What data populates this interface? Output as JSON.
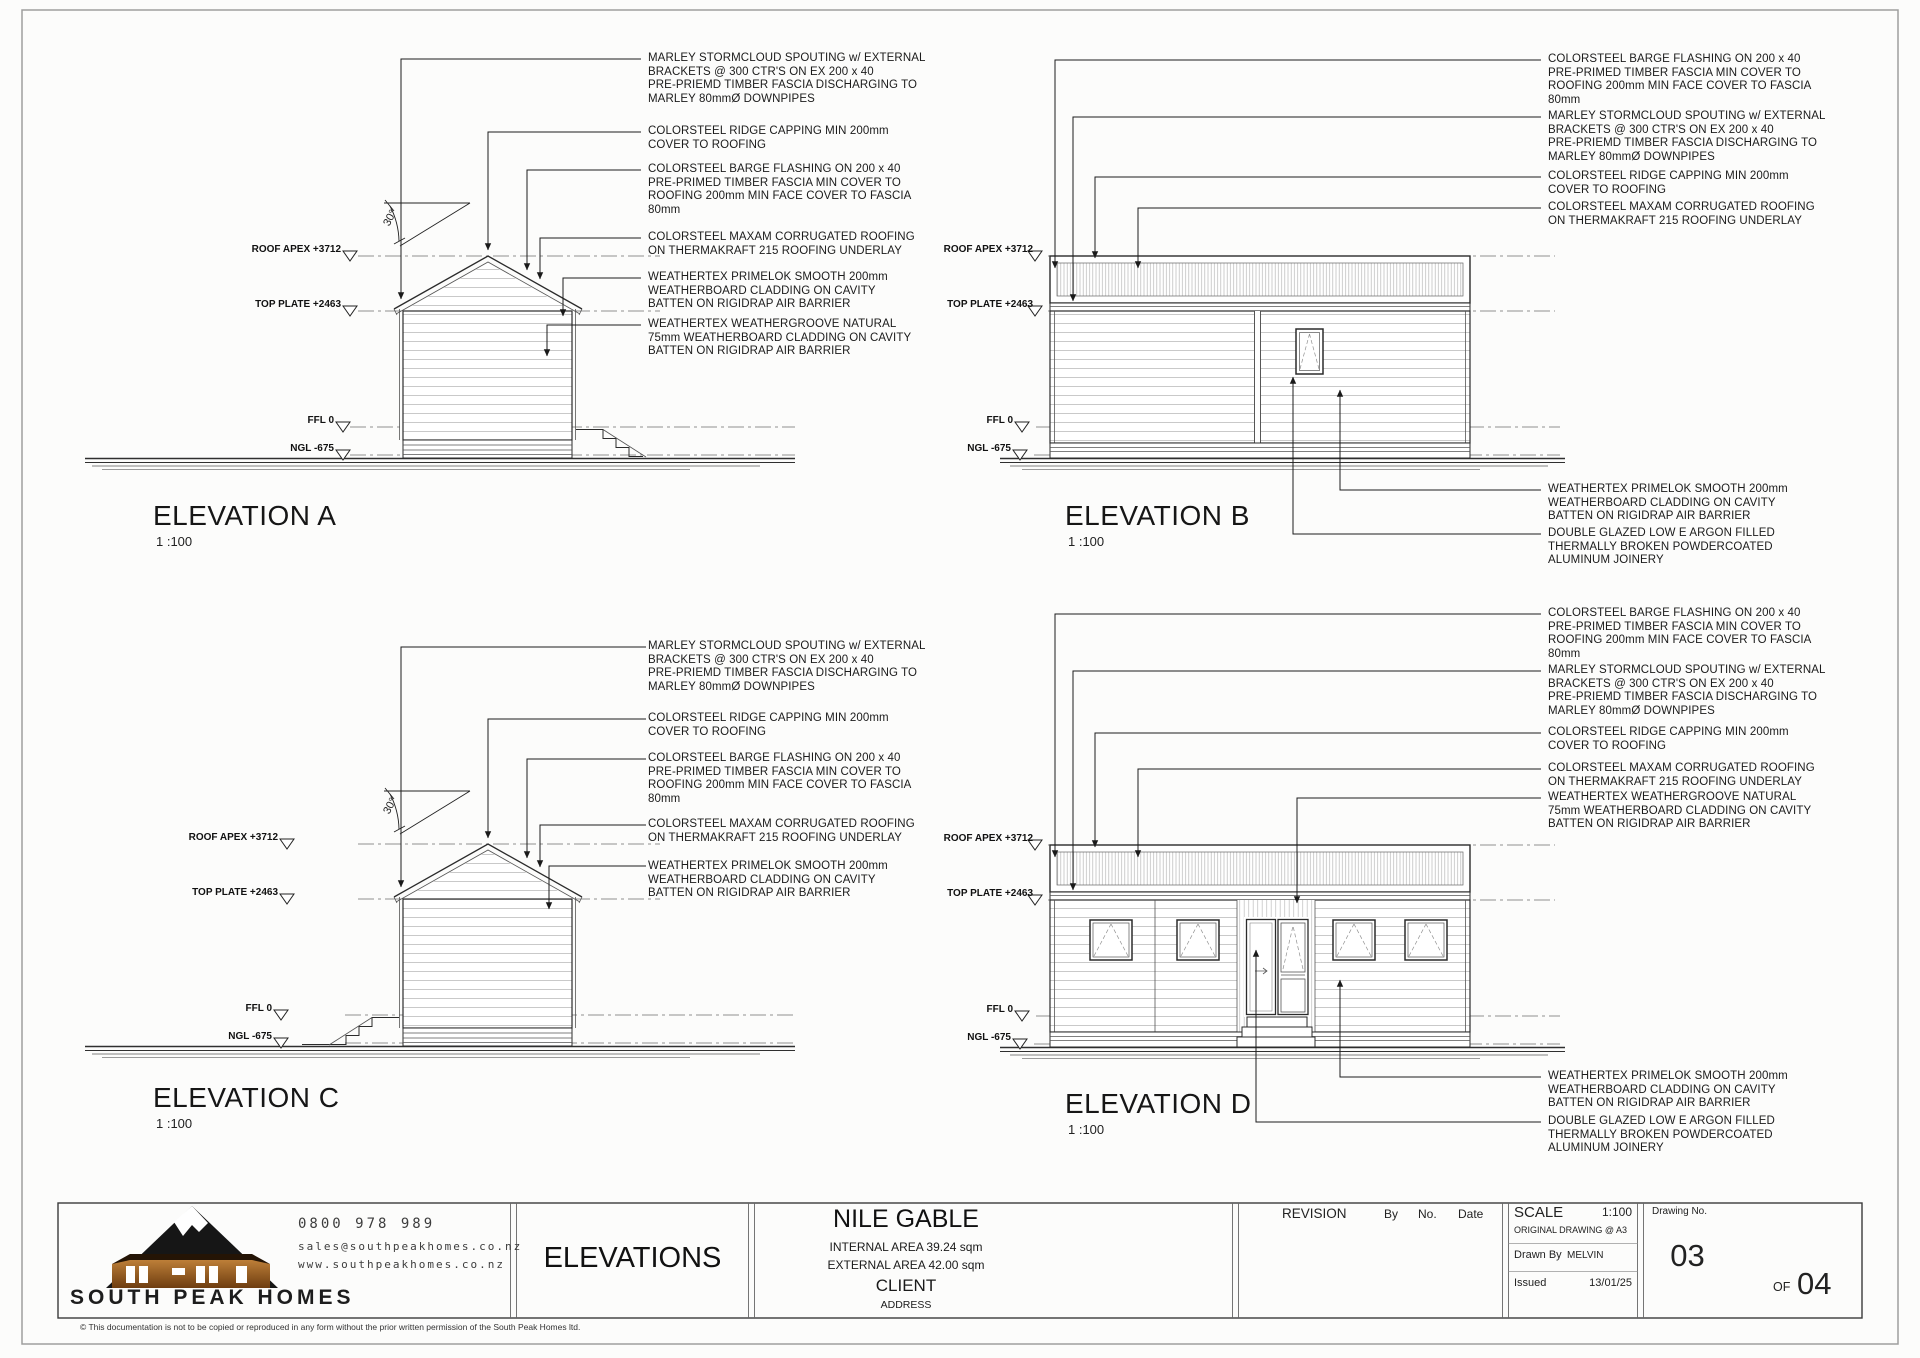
{
  "sheet": {
    "elevations": [
      {
        "id": "A",
        "title": "ELEVATION A",
        "scale": "1 :100"
      },
      {
        "id": "B",
        "title": "ELEVATION B",
        "scale": "1 :100"
      },
      {
        "id": "C",
        "title": "ELEVATION C",
        "scale": "1 :100"
      },
      {
        "id": "D",
        "title": "ELEVATION D",
        "scale": "1 :100"
      }
    ],
    "datum": {
      "roof_apex": "ROOF APEX +3712",
      "top_plate": "TOP PLATE +2463",
      "ffl": "FFL 0",
      "ngl": "NGL -675"
    },
    "angle_label": "30°",
    "notes": {
      "marley": "MARLEY STORMCLOUD SPOUTING w/ EXTERNAL\nBRACKETS @ 300 CTR'S ON EX 200 x 40\nPRE-PRIEMD TIMBER FASCIA DISCHARGING TO\nMARLEY 80mmØ DOWNPIPES",
      "ridge": "COLORSTEEL RIDGE CAPPING MIN 200mm\nCOVER TO ROOFING",
      "barge": "COLORSTEEL BARGE FLASHING ON 200 x 40\nPRE-PRIMED TIMBER FASCIA MIN COVER TO\nROOFING 200mm MIN FACE COVER TO FASCIA\n80mm",
      "maxam": "COLORSTEEL MAXAM CORRUGATED ROOFING\nON THERMAKRAFT 215 ROOFING UNDERLAY",
      "primelok": "WEATHERTEX PRIMELOK SMOOTH 200mm\nWEATHERBOARD CLADDING ON CAVITY\nBATTEN ON RIGIDRAP AIR BARRIER",
      "weathergroove": "WEATHERTEX WEATHERGROOVE NATURAL\n75mm WEATHERBOARD CLADDING ON CAVITY\nBATTEN ON RIGIDRAP AIR BARRIER",
      "double_glazed": "DOUBLE GLAZED LOW E ARGON FILLED\nTHERMALLY BROKEN POWDERCOATED\nALUMINUM JOINERY"
    }
  },
  "title_block": {
    "company": "SOUTH PEAK HOMES",
    "phone": "0800 978 989",
    "email": "sales@southpeakhomes.co.nz",
    "website": "www.southpeakhomes.co.nz",
    "sheet_title": "ELEVATIONS",
    "project": "NILE GABLE",
    "internal_area": "INTERNAL AREA 39.24 sqm",
    "external_area": "EXTERNAL AREA 42.00 sqm",
    "client_label": "CLIENT",
    "address_label": "ADDRESS",
    "revision_label": "REVISION",
    "by_label": "By",
    "no_label": "No.",
    "date_label": "Date",
    "scale_label": "SCALE",
    "scale_value": "1:100",
    "original_drawing": "ORIGINAL DRAWING @ A3",
    "drawn_by_label": "Drawn By",
    "drawn_by": "MELVIN",
    "issued_label": "Issued",
    "issued_date": "13/01/25",
    "drawing_no_label": "Drawing No.",
    "drawing_no": "03",
    "of_label": "OF",
    "total": "04",
    "logo_accent": "#a8641f",
    "line_color": "#2b2b2b"
  },
  "footer": {
    "copyright": "© This documentation is not to be copied or reproduced in any form without the prior written permission of the South Peak Homes ltd."
  }
}
